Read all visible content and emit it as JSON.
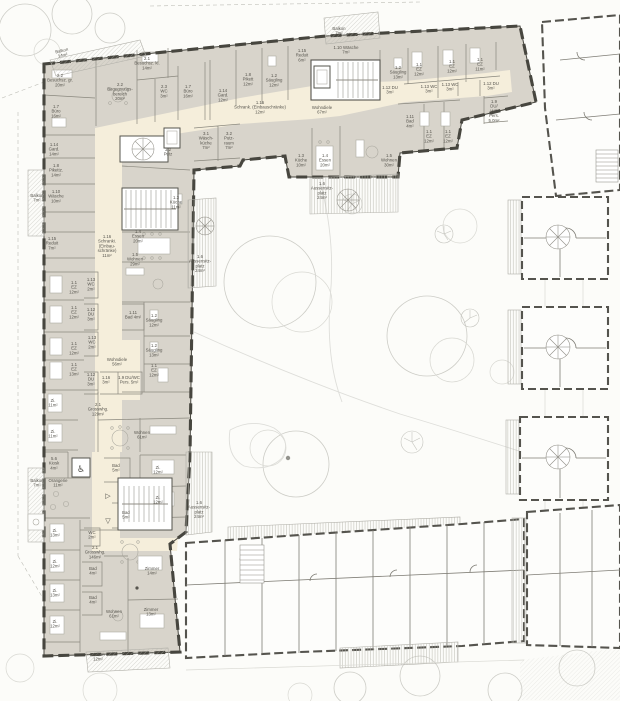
{
  "drawing": {
    "kind": "architectural floor plan",
    "building": "care / residential facility with courtyard garden"
  },
  "colors": {
    "paper": "#fcfcf9",
    "wall_dark": "#47463f",
    "room_fill": "#d8d4cb",
    "corridor_fill": "#f5eedb",
    "context_line": "#cdcdc7",
    "text": "#57554e",
    "hatch_line": "#b6b5ae"
  },
  "labels": [
    {
      "id": "balkon-14",
      "x": 62,
      "y": 52,
      "rot": -13,
      "lines": [
        "Balkon",
        "14m²"
      ]
    },
    {
      "id": "besuchsz-gr",
      "x": 60,
      "y": 77,
      "lines": [
        "2.2",
        "Besuchsz. gr.",
        "20m²"
      ]
    },
    {
      "id": "buero-left",
      "x": 56,
      "y": 108,
      "lines": [
        "1.7",
        "Büro",
        "16m²"
      ]
    },
    {
      "id": "gard-14",
      "x": 54,
      "y": 146,
      "lines": [
        "1.14",
        "Gard.",
        "14m²"
      ]
    },
    {
      "id": "pikettz-14",
      "x": 56,
      "y": 167,
      "lines": [
        "1.8",
        "Pikettz.",
        "14m²"
      ]
    },
    {
      "id": "balkon-7-a",
      "x": 37,
      "y": 197,
      "lines": [
        "Balkon",
        "7m²"
      ]
    },
    {
      "id": "waesche-10",
      "x": 56,
      "y": 193,
      "lines": [
        "1.10",
        "Wäsche",
        "10m²"
      ]
    },
    {
      "id": "reduit-7",
      "x": 52,
      "y": 240,
      "lines": [
        "1.15",
        "Reduit",
        "7m²"
      ]
    },
    {
      "id": "begegnungsbereich",
      "x": 120,
      "y": 86,
      "lines": [
        "2.2",
        "Begegnungs-",
        "bereich",
        "20m²"
      ]
    },
    {
      "id": "besuchsz-kl",
      "x": 147,
      "y": 60,
      "lines": [
        "2.1",
        "Besuchsz. kl.",
        "14m²"
      ]
    },
    {
      "id": "wc-23",
      "x": 164,
      "y": 88,
      "lines": [
        "2.3",
        "WC",
        "3m²"
      ]
    },
    {
      "id": "buero-top",
      "x": 188,
      "y": 88,
      "lines": [
        "1.7",
        "Büro",
        "16m²"
      ]
    },
    {
      "id": "gard-12",
      "x": 223,
      "y": 92,
      "lines": [
        "1.14",
        "Gard.",
        "12m²"
      ]
    },
    {
      "id": "pikett-12",
      "x": 248,
      "y": 76,
      "lines": [
        "1.8",
        "Pikett",
        "12m²"
      ]
    },
    {
      "id": "saeugling-a",
      "x": 274,
      "y": 77,
      "lines": [
        "1.2",
        "Säugling",
        "12m²"
      ]
    },
    {
      "id": "reduit-6",
      "x": 302,
      "y": 52,
      "lines": [
        "1.15",
        "Reduit",
        "6m²"
      ]
    },
    {
      "id": "balkon-7-top",
      "x": 339,
      "y": 30,
      "lines": [
        "Balkon",
        "7m²"
      ]
    },
    {
      "id": "waesche-7",
      "x": 346,
      "y": 49,
      "lines": [
        "1.10 Wäsche",
        "7m²"
      ]
    },
    {
      "id": "schrank-12",
      "x": 260,
      "y": 104,
      "lines": [
        "1.16",
        "Schrank. (Einbauschränke)",
        "12m²"
      ]
    },
    {
      "id": "wohndiele-67",
      "x": 322,
      "y": 109,
      "lines": [
        "Wohndiele",
        "67m²"
      ]
    },
    {
      "id": "waeschkueche-7",
      "x": 206,
      "y": 135,
      "lines": [
        "3.1",
        "Wäsch-",
        "küche",
        "7m²"
      ]
    },
    {
      "id": "putzraum-7",
      "x": 229,
      "y": 135,
      "lines": [
        "3.2",
        "Putz-",
        "raum",
        "7m²"
      ]
    },
    {
      "id": "putz-32",
      "x": 168,
      "y": 151,
      "lines": [
        "3.2",
        "Putz"
      ]
    },
    {
      "id": "saeugling-b",
      "x": 398,
      "y": 69,
      "lines": [
        "1.2",
        "Säugling",
        "13m²"
      ]
    },
    {
      "id": "du-3-a",
      "x": 390,
      "y": 89,
      "lines": [
        "1.12 DU",
        "3m²"
      ]
    },
    {
      "id": "ez-a",
      "x": 419,
      "y": 66,
      "lines": [
        "1.1",
        "EZ",
        "12m²"
      ]
    },
    {
      "id": "ez-b",
      "x": 452,
      "y": 63,
      "lines": [
        "1.1",
        "EZ",
        "12m²"
      ]
    },
    {
      "id": "ez-c",
      "x": 480,
      "y": 61,
      "lines": [
        "1.1",
        "EZ",
        "11m²"
      ]
    },
    {
      "id": "wc-113-a",
      "x": 429,
      "y": 88,
      "lines": [
        "1.13 WC",
        "3m²"
      ]
    },
    {
      "id": "wc-113-b",
      "x": 450,
      "y": 86,
      "lines": [
        "1.13 WC",
        "3m²"
      ]
    },
    {
      "id": "du-3-b",
      "x": 491,
      "y": 85,
      "lines": [
        "1.12 DU",
        "3m²"
      ]
    },
    {
      "id": "duwc-pers-5",
      "x": 494,
      "y": 103,
      "lines": [
        "1.9",
        "DU/",
        "WC",
        "Pers.",
        "5.0m²"
      ]
    },
    {
      "id": "bad-4-a",
      "x": 410,
      "y": 118,
      "lines": [
        "1.11",
        "Bad",
        "4m²"
      ]
    },
    {
      "id": "ez-d",
      "x": 429,
      "y": 133,
      "lines": [
        "1.1",
        "EZ",
        "12m²"
      ]
    },
    {
      "id": "ez-e",
      "x": 448,
      "y": 133,
      "lines": [
        "1.1",
        "EZ",
        "12m²"
      ]
    },
    {
      "id": "wohnen-30",
      "x": 389,
      "y": 157,
      "lines": [
        "1.5",
        "Wohnen",
        "30m²"
      ]
    },
    {
      "id": "essen-20-b",
      "x": 325,
      "y": 157,
      "lines": [
        "1.4",
        "Essen",
        "20m²"
      ]
    },
    {
      "id": "kueche-10",
      "x": 301,
      "y": 157,
      "lines": [
        "1.3",
        "Küche",
        "10m²"
      ]
    },
    {
      "id": "terrasse-top",
      "x": 322,
      "y": 185,
      "lines": [
        "1.6",
        "Aussensitz-",
        "platz",
        "24m²"
      ]
    },
    {
      "id": "kueche-11",
      "x": 176,
      "y": 199,
      "lines": [
        "1.3",
        "Küche",
        "11m²"
      ]
    },
    {
      "id": "essen-20-a",
      "x": 138,
      "y": 233,
      "lines": [
        "1.4",
        "Essen",
        "20m²"
      ]
    },
    {
      "id": "schranki-11",
      "x": 107,
      "y": 238,
      "lines": [
        "1.16",
        "Schranki.",
        "(Einbau-",
        "schränke)",
        "11m²"
      ]
    },
    {
      "id": "wohnen-29",
      "x": 135,
      "y": 256,
      "lines": [
        "1.5",
        "Wohnen",
        "29m²"
      ]
    },
    {
      "id": "terrasse-left",
      "x": 200,
      "y": 258,
      "lines": [
        "1.6",
        "Aussensitz-",
        "platz",
        "24m²"
      ]
    },
    {
      "id": "wc-2-a",
      "x": 91,
      "y": 281,
      "lines": [
        "1.13",
        "WC",
        "2m²"
      ]
    },
    {
      "id": "ez-l1",
      "x": 74,
      "y": 284,
      "lines": [
        "1.1",
        "EZ",
        "12m²"
      ]
    },
    {
      "id": "ez-l2",
      "x": 74,
      "y": 309,
      "lines": [
        "1.1",
        "EZ",
        "12m²"
      ]
    },
    {
      "id": "du-l1",
      "x": 91,
      "y": 311,
      "lines": [
        "1.12",
        "DU",
        "3m²"
      ]
    },
    {
      "id": "bad-4-b",
      "x": 133,
      "y": 314,
      "lines": [
        "1.11",
        "Bad 4m²"
      ]
    },
    {
      "id": "saeugling-c",
      "x": 154,
      "y": 317,
      "lines": [
        "1.2",
        "Säugling",
        "12m²"
      ]
    },
    {
      "id": "ez-l3",
      "x": 74,
      "y": 345,
      "lines": [
        "1.1",
        "EZ",
        "12m²"
      ]
    },
    {
      "id": "wc-2-b",
      "x": 92,
      "y": 339,
      "lines": [
        "1.13",
        "WC",
        "2m²"
      ]
    },
    {
      "id": "saeugling-d",
      "x": 154,
      "y": 347,
      "lines": [
        "1.2",
        "Säugling",
        "13m²"
      ]
    },
    {
      "id": "ez-l4",
      "x": 74,
      "y": 366,
      "lines": [
        "1.1",
        "EZ",
        "13m²"
      ]
    },
    {
      "id": "du-l2",
      "x": 91,
      "y": 376,
      "lines": [
        "1.12",
        "DU",
        "3m²"
      ]
    },
    {
      "id": "wohndiele-56",
      "x": 117,
      "y": 361,
      "lines": [
        "Wohndiele",
        "56m²"
      ]
    },
    {
      "id": "ez-l5",
      "x": 154,
      "y": 367,
      "lines": [
        "1.1",
        "EZ",
        "12m²"
      ]
    },
    {
      "id": "s116-3",
      "x": 106,
      "y": 379,
      "lines": [
        "1.16",
        "3m²"
      ]
    },
    {
      "id": "duwc-5",
      "x": 129,
      "y": 379,
      "lines": [
        "1.9 DU/WC",
        "Pers. 5m²"
      ]
    },
    {
      "id": "zi-11-1",
      "x": 53,
      "y": 402,
      "lines": [
        "Zi.",
        "11m²"
      ]
    },
    {
      "id": "grosswhg-129",
      "x": 98,
      "y": 406,
      "lines": [
        "2.1",
        "Grosswhg.",
        "129m²"
      ]
    },
    {
      "id": "zi-11-2",
      "x": 53,
      "y": 433,
      "lines": [
        "Zi.",
        "11m²"
      ]
    },
    {
      "id": "wohnen-61-a",
      "x": 142,
      "y": 434,
      "lines": [
        "Wohnen",
        "61m²"
      ]
    },
    {
      "id": "kiosk",
      "x": 54,
      "y": 460,
      "lines": [
        "5.6",
        "Kiosk",
        "4m²"
      ]
    },
    {
      "id": "bad-5-1",
      "x": 116,
      "y": 467,
      "lines": [
        "Bad",
        "5m²"
      ]
    },
    {
      "id": "zi-12-r1",
      "x": 158,
      "y": 469,
      "lines": [
        "Zi.",
        "12m²"
      ]
    },
    {
      "id": "balkon-7-b",
      "x": 37,
      "y": 482,
      "lines": [
        "Balkon",
        "7m²"
      ]
    },
    {
      "id": "orangerie",
      "x": 58,
      "y": 482,
      "lines": [
        "Orangerie",
        "11m²"
      ]
    },
    {
      "id": "zi-12-r2",
      "x": 158,
      "y": 499,
      "lines": [
        "Zi.",
        "12m²"
      ]
    },
    {
      "id": "bad-5-2",
      "x": 126,
      "y": 514,
      "lines": [
        "Bad",
        "5m²"
      ]
    },
    {
      "id": "terrasse-bottom",
      "x": 199,
      "y": 504,
      "lines": [
        "1.6",
        "Aussensitz-",
        "platz",
        "24m²"
      ]
    },
    {
      "id": "wc-2-c",
      "x": 92,
      "y": 534,
      "lines": [
        "WC",
        "2m²"
      ]
    },
    {
      "id": "grosswhg-146",
      "x": 95,
      "y": 549,
      "lines": [
        "2.1",
        "Grosswhg.",
        "146m²"
      ]
    },
    {
      "id": "zi-13-b1",
      "x": 55,
      "y": 532,
      "lines": [
        "Zi.",
        "13m²"
      ]
    },
    {
      "id": "zi-12-b2",
      "x": 55,
      "y": 563,
      "lines": [
        "Zi.",
        "12m²"
      ]
    },
    {
      "id": "zi-13-b3",
      "x": 55,
      "y": 592,
      "lines": [
        "Zi.",
        "13m²"
      ]
    },
    {
      "id": "zi-12-b4",
      "x": 55,
      "y": 623,
      "lines": [
        "Zi.",
        "12m²"
      ]
    },
    {
      "id": "bad-4-c1",
      "x": 93,
      "y": 570,
      "lines": [
        "Bad",
        "4m²"
      ]
    },
    {
      "id": "bad-4-c2",
      "x": 93,
      "y": 599,
      "lines": [
        "Bad",
        "4m²"
      ]
    },
    {
      "id": "wohnen-61-b",
      "x": 114,
      "y": 613,
      "lines": [
        "Wohnen",
        "61m²"
      ]
    },
    {
      "id": "zimmer-14",
      "x": 152,
      "y": 570,
      "lines": [
        "Zimmer",
        "14m²"
      ]
    },
    {
      "id": "zimmer-13",
      "x": 151,
      "y": 611,
      "lines": [
        "Zimmer",
        "13m²"
      ]
    },
    {
      "id": "balkon-12",
      "x": 98,
      "y": 656,
      "lines": [
        "Balkon",
        "12m²"
      ]
    }
  ],
  "icons": [
    {
      "id": "wheelchair-icon",
      "glyph": "♿",
      "x": 81,
      "y": 472,
      "size": 9
    },
    {
      "id": "triangle-right-icon",
      "glyph": "▷",
      "x": 108,
      "y": 498,
      "size": 7
    },
    {
      "id": "triangle-down-icon",
      "glyph": "▽",
      "x": 108,
      "y": 523,
      "size": 7
    }
  ]
}
